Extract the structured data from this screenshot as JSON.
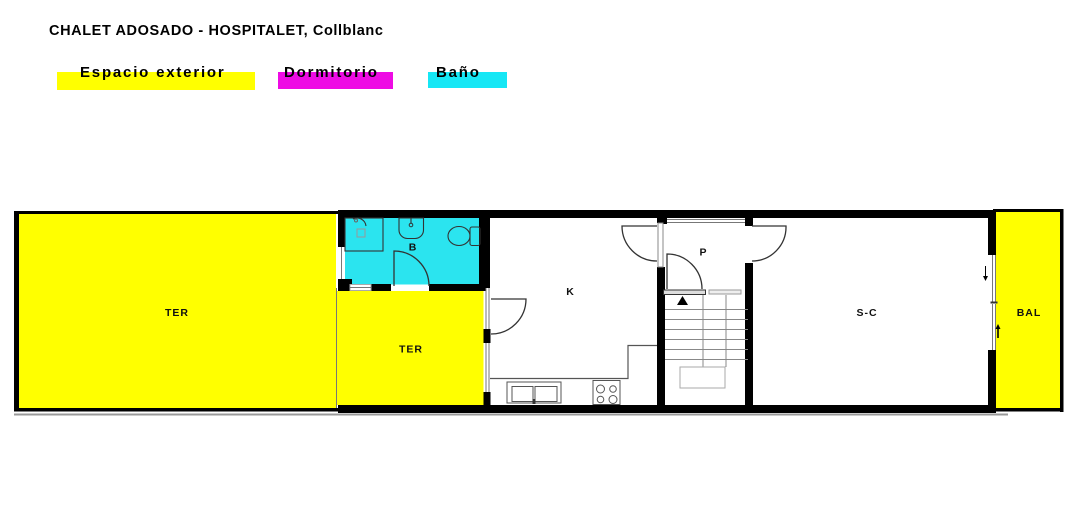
{
  "title": "CHALET ADOSADO - HOSPITALET, Collblanc",
  "legend": {
    "items": [
      {
        "label": "Espacio exterior",
        "color": "#FFFF00"
      },
      {
        "label": "Dormitorio",
        "color": "#EE0BE4"
      },
      {
        "label": "Baño",
        "color": "#16E7F5"
      }
    ]
  },
  "colors": {
    "exterior": "#FFFF00",
    "bathroom_fill": "#2BE4EF",
    "wall": "#000000"
  },
  "rooms": {
    "ter_left": {
      "label": "TER"
    },
    "ter_patio": {
      "label": "TER"
    },
    "bathroom": {
      "label": "B"
    },
    "kitchen": {
      "label": "K"
    },
    "hall": {
      "label": "P"
    },
    "living": {
      "label": "S-C"
    },
    "balcony": {
      "label": "BAL"
    }
  }
}
